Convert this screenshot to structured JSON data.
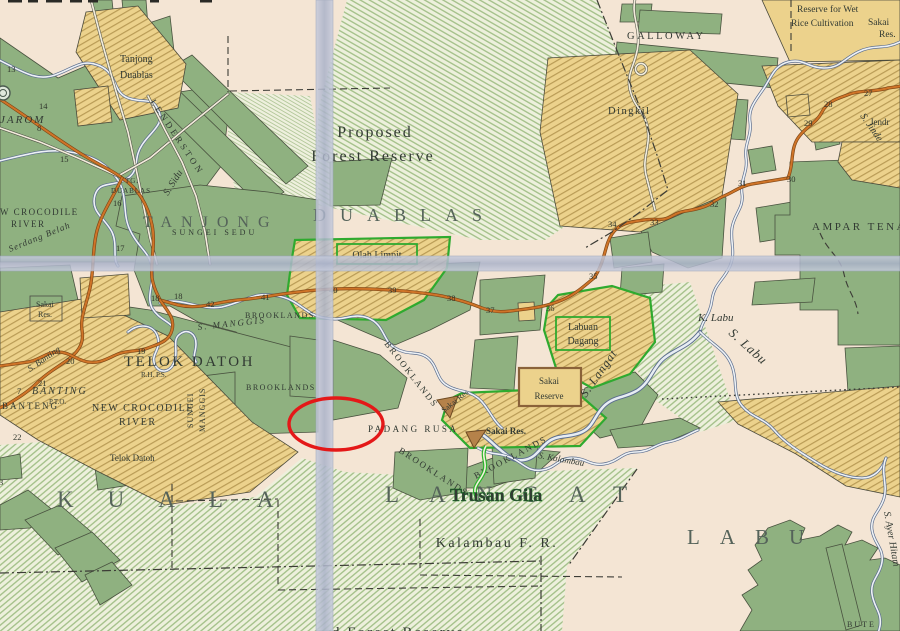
{
  "map": {
    "districts": {
      "tanjong": "TANJONG",
      "duablas": "DUABLAS",
      "kuala": "KUALA",
      "langat": "LANGAT",
      "labu": "LABU"
    },
    "regions": {
      "proposed1": "Proposed",
      "proposed2": "Forest Reserve",
      "kalambau_fr": "Kalambau F. R.",
      "ampar": "AMPAR TENANG",
      "galloway": "GALLOWAY",
      "dingkil": "Dingkil",
      "wet1": "Reserve for Wet",
      "wet2": "Rice Cultivation",
      "sakai_ne1": "Sakai",
      "sakai_ne2": "Res.",
      "telok": "TELOK DATOH",
      "telok_sub": "R.H. P.S.",
      "telok_small": "Telok Datoh",
      "banting_i": "BANTING",
      "pto": "P.T.O.",
      "banteng": "BANTENG",
      "jarom": "JAROM",
      "lenderston": "LENDERSTON",
      "tj1": "Tanjong",
      "tj2": "Duablas",
      "tg1": "TG.",
      "tg2": "DUABLAS",
      "sungei_sedu": "SUNGEI SEDU",
      "croc1a": "W CROCODILE",
      "croc1b": "RIVER",
      "croc2a": "NEW CROCODILE",
      "croc2b": "RIVER",
      "padang": "PADANG RUSA",
      "brooklands": "BROOKLANDS",
      "sakai_w1": "Sakai",
      "sakai_w2": "Res.",
      "sakai_c": "Sakai Res.",
      "sakai_diag": "Sakai Res",
      "sakai_box1": "Sakai",
      "sakai_box2": "Reserve",
      "labuan1": "Labuan",
      "labuan2": "Dagang",
      "olah": "Olah Limpit",
      "bute": "BUTE",
      "fr_cut": "d Forest Reserve"
    },
    "rivers": {
      "s_sidu": "S. Sidu",
      "serdang": "Serdang Belah",
      "s_manggis": "S. MANGGIS",
      "sungei_v": "SUNGEI",
      "manggis_v": "MANGGIS",
      "s_banting": "S. Banting",
      "k_labu": "K. Labu",
      "s_labu": "S. Labu",
      "s_langat": "S. Langat",
      "s_kalambau": "S. Kalambau",
      "s_jinde": "S. Jinde",
      "jendr": "Jendr",
      "ayer": "S. Ayer Hitam"
    },
    "milestones": {
      "n3": "3",
      "n7": "7",
      "n8": "8",
      "n13": "13",
      "n14": "14",
      "n15": "15",
      "n16": "16",
      "n17": "17",
      "n18a": "18",
      "n18b": "18",
      "n19": "19",
      "n20": "20",
      "n21": "21",
      "n22": "22",
      "n27": "27",
      "n28": "28",
      "n29": "29",
      "n30": "30",
      "n31": "31",
      "n32": "32",
      "n33": "33",
      "n34": "34",
      "n35": "35",
      "n36": "36",
      "n37": "37",
      "n38": "38",
      "n39": "39",
      "n40": "40",
      "n41": "41",
      "n42": "42"
    },
    "annotations": {
      "trusan": "Trusan Gila",
      "ellipse_color": "#e41818",
      "highlight_green": "#2db52d"
    },
    "colors": {
      "paper": "#f4e5d4",
      "forest_green": "#8fb180",
      "hatch_green": "#a6c28c",
      "tan": "#ecd28c",
      "road_orange": "#cf7428",
      "river_blue": "#5c6e8e",
      "fold_band": "#b9c0d4"
    }
  }
}
